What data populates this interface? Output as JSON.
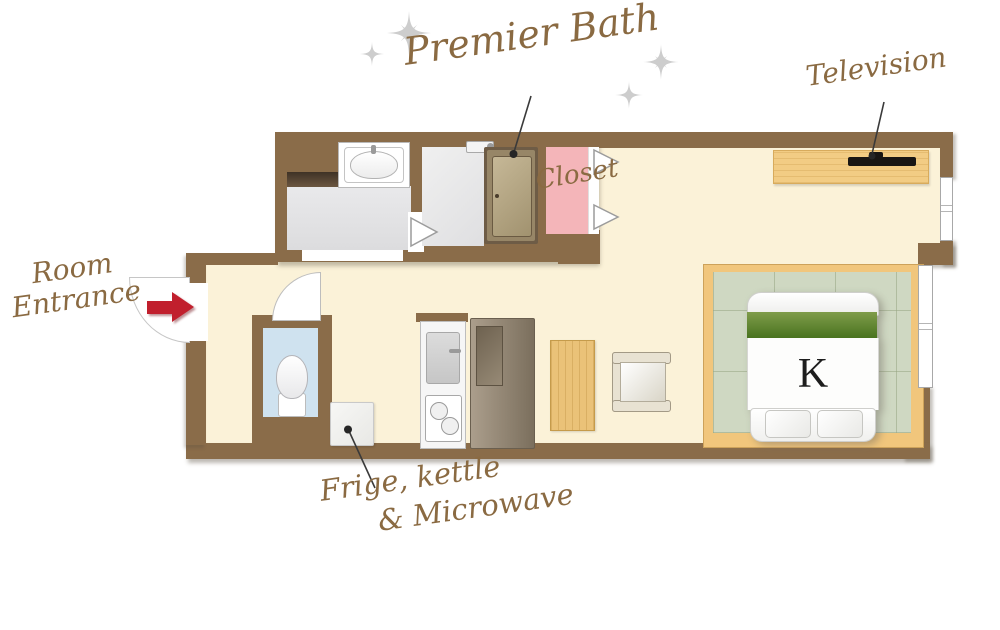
{
  "labels": {
    "premier_bath": "Premier Bath",
    "television": "Television",
    "room_entrance_line1": "Room",
    "room_entrance_line2": "Entrance",
    "closet": "Closet",
    "fridge_line1": "Frige, kettle",
    "fridge_line2": "& Microwave",
    "bed_size": "K"
  },
  "colors": {
    "wall_brown": "#8a6c49",
    "floor_cream": "#fbf2d8",
    "tatami_green": "#cfd8c2",
    "platform_wood": "#f1c67c",
    "closet_pink": "#f4b5b9",
    "toilet_blue": "#cfe2ef",
    "light_wood": "#f2cc84",
    "bed_band_green": "#5d8631",
    "label_text_brown": "#8a6a42",
    "entrance_arrow_red": "#c11f2d",
    "tv_black": "#191613"
  },
  "icons": {
    "entrance_arrow": "red right-pointing arrow",
    "sparkle": "thin four-point sparkle star",
    "door_swing": "quarter-circle door swing symbol",
    "closet_door_chevron": "white right-pointing fold-door triangle",
    "leader_dot": "black callout dot"
  }
}
